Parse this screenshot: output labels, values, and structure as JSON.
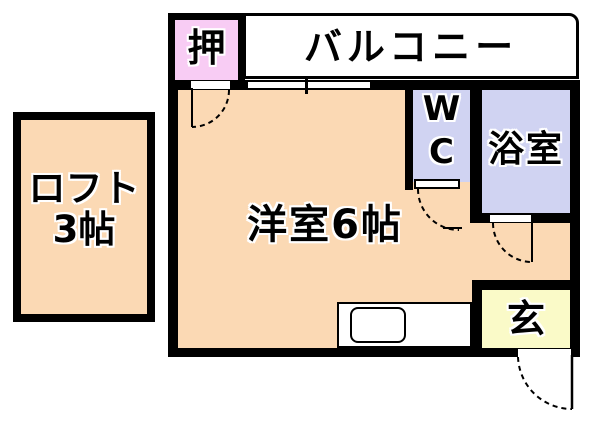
{
  "rooms": {
    "loft": {
      "name": "ロフト",
      "size": "3帖"
    },
    "closet": {
      "label": "押"
    },
    "balcony": {
      "label": "バルコニー"
    },
    "main_room": {
      "label": "洋室6帖"
    },
    "wc": {
      "line1": "W",
      "line2": "C"
    },
    "bath": {
      "label": "浴室"
    },
    "entrance": {
      "label": "玄"
    }
  },
  "colors": {
    "wall": "#000000",
    "room_fill": "#fbd9b4",
    "closet_fill": "#f8ccf4",
    "wet_area_fill": "#d0d3f2",
    "entrance_fill": "#fafac8",
    "background": "#ffffff"
  }
}
